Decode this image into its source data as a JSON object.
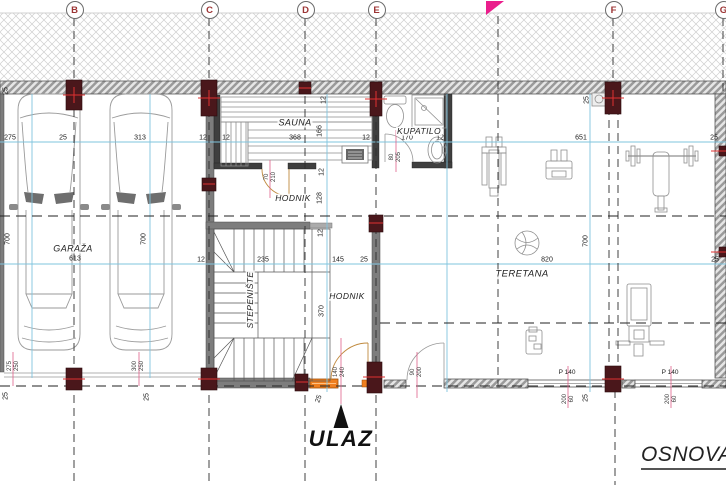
{
  "drawing": {
    "title": "OSNOVA",
    "entrance_label": "ULAZ"
  },
  "colors": {
    "flag": "#ea1e8c",
    "column": "#4a171b",
    "sill": "#ef7f1f",
    "dimline": "#7fc4de",
    "tick": "#e560a0"
  },
  "grid_bubbles": [
    {
      "label": "B",
      "x": 74
    },
    {
      "label": "C",
      "x": 209
    },
    {
      "label": "D",
      "x": 305
    },
    {
      "label": "E",
      "x": 376
    },
    {
      "label": "F",
      "x": 613
    },
    {
      "label": "G",
      "x": 723
    }
  ],
  "room_labels": [
    {
      "t": "GARAŽA",
      "x": 73,
      "y": 249,
      "s": 9
    },
    {
      "t": "SAUNA",
      "x": 295,
      "y": 123,
      "s": 9
    },
    {
      "t": "KUPATILO",
      "x": 419,
      "y": 131
    },
    {
      "t": "HODNIK",
      "x": 293,
      "y": 198
    },
    {
      "t": "HODNIK",
      "x": 347,
      "y": 296
    },
    {
      "t": "STEPENIŠTE",
      "x": 250,
      "y": 300,
      "r": -90
    },
    {
      "t": "TERETANA",
      "x": 522,
      "y": 274,
      "s": 9.5
    }
  ],
  "dim_labels": [
    {
      "t": "275",
      "x": 10,
      "y": 138
    },
    {
      "t": "25",
      "x": 63,
      "y": 138
    },
    {
      "t": "313",
      "x": 140,
      "y": 138
    },
    {
      "t": "12",
      "x": 203,
      "y": 138
    },
    {
      "t": "12",
      "x": 226,
      "y": 138
    },
    {
      "t": "368",
      "x": 295,
      "y": 138
    },
    {
      "t": "12",
      "x": 366,
      "y": 138
    },
    {
      "t": "170",
      "x": 407,
      "y": 138
    },
    {
      "t": "12",
      "x": 440,
      "y": 138
    },
    {
      "t": "651",
      "x": 581,
      "y": 138
    },
    {
      "t": "25",
      "x": 714,
      "y": 138
    },
    {
      "t": "12",
      "x": 201,
      "y": 260
    },
    {
      "t": "235",
      "x": 263,
      "y": 260
    },
    {
      "t": "145",
      "x": 338,
      "y": 260
    },
    {
      "t": "25",
      "x": 364,
      "y": 260
    },
    {
      "t": "820",
      "x": 547,
      "y": 260
    },
    {
      "t": "25",
      "x": 715,
      "y": 260
    },
    {
      "t": "613",
      "x": 75,
      "y": 259
    },
    {
      "t": "P 140",
      "x": 567,
      "y": 373,
      "s": 6.5
    },
    {
      "t": "P 140",
      "x": 670,
      "y": 373,
      "s": 6.5
    },
    {
      "t": "700",
      "x": 8,
      "y": 239,
      "r": -90
    },
    {
      "t": "700",
      "x": 144,
      "y": 239,
      "r": -90
    },
    {
      "t": "700",
      "x": 586,
      "y": 241,
      "r": -90
    },
    {
      "t": "370",
      "x": 322,
      "y": 311,
      "r": -90
    },
    {
      "t": "128",
      "x": 320,
      "y": 198,
      "r": -90
    },
    {
      "t": "166",
      "x": 320,
      "y": 131,
      "r": -90
    },
    {
      "t": "12",
      "x": 324,
      "y": 100,
      "r": -90
    },
    {
      "t": "12",
      "x": 322,
      "y": 172,
      "r": -90
    },
    {
      "t": "12",
      "x": 321,
      "y": 233,
      "r": -90
    },
    {
      "t": "25",
      "x": 6,
      "y": 91,
      "r": -90
    },
    {
      "t": "25",
      "x": 587,
      "y": 100,
      "r": -90
    },
    {
      "t": "25",
      "x": 6,
      "y": 396,
      "r": -90
    },
    {
      "t": "25",
      "x": 147,
      "y": 397,
      "r": -90
    },
    {
      "t": "25",
      "x": 319,
      "y": 399,
      "r": -70
    },
    {
      "t": "25",
      "x": 586,
      "y": 398,
      "r": -90
    }
  ],
  "door_dim_labels": [
    {
      "t": "70",
      "x": 267,
      "y": 177,
      "r": -90
    },
    {
      "t": "210",
      "x": 274,
      "y": 177,
      "r": -90
    },
    {
      "t": "80",
      "x": 392,
      "y": 157,
      "r": -90
    },
    {
      "t": "205",
      "x": 399,
      "y": 157,
      "r": -90
    },
    {
      "t": "140",
      "x": 336,
      "y": 372,
      "r": -90
    },
    {
      "t": "240",
      "x": 343,
      "y": 372,
      "r": -90
    },
    {
      "t": "90",
      "x": 413,
      "y": 372,
      "r": -90
    },
    {
      "t": "200",
      "x": 420,
      "y": 372,
      "r": -90
    },
    {
      "t": "275",
      "x": 10,
      "y": 366,
      "r": -90
    },
    {
      "t": "250",
      "x": 17,
      "y": 366,
      "r": -90
    },
    {
      "t": "300",
      "x": 135,
      "y": 366,
      "r": -90
    },
    {
      "t": "250",
      "x": 142,
      "y": 366,
      "r": -90
    },
    {
      "t": "200",
      "x": 565,
      "y": 399,
      "r": -90
    },
    {
      "t": "60",
      "x": 572,
      "y": 399,
      "r": -90
    },
    {
      "t": "200",
      "x": 668,
      "y": 399,
      "r": -90
    },
    {
      "t": "60",
      "x": 675,
      "y": 399,
      "r": -90
    }
  ]
}
